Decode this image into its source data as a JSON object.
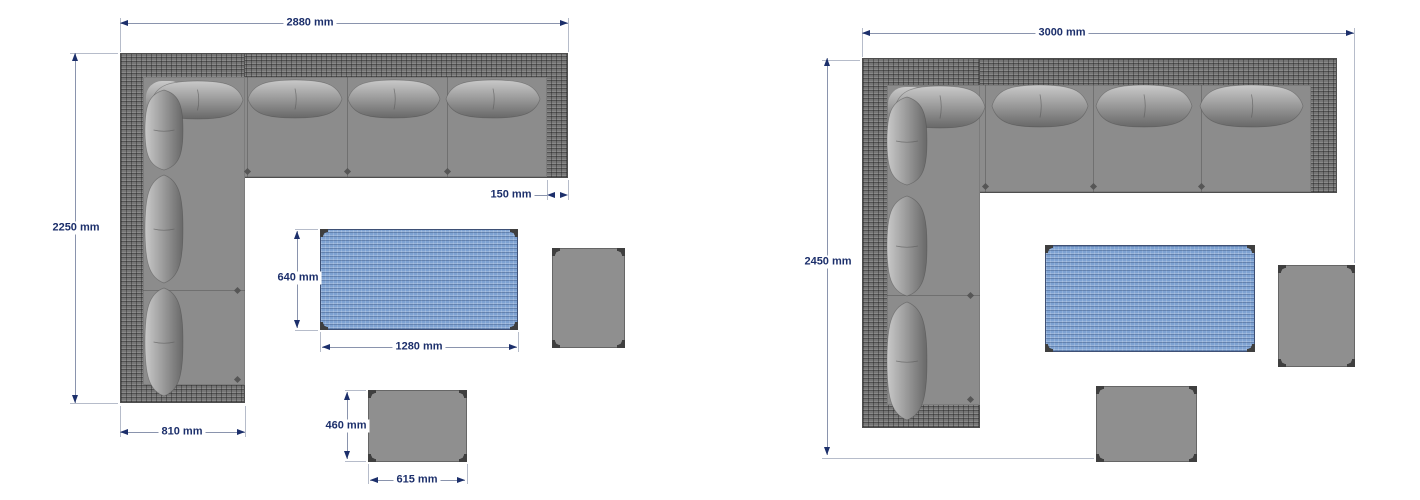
{
  "drawing_title": "corner sofa set dimension plans",
  "colors": {
    "dimension_text": "#1c2f6b",
    "dimension_line": "#8a94ad",
    "extension_line": "#b6bcca",
    "wicker_frame": "#767676",
    "sofa_seat": "#8c8c8c",
    "cushion": "#9e9e9e",
    "table_top": "#7ea2d2",
    "stool_top": "#8f8f8f",
    "background": "#ffffff"
  },
  "left_set": {
    "name": "corner sofa set (left plan)",
    "dimensions": {
      "overall_width": "2880 mm",
      "overall_depth": "2250 mm",
      "armrest_width": "150 mm",
      "arm_section_width": "810 mm",
      "table_depth": "640 mm",
      "table_width": "1280 mm",
      "ottoman_depth": "460 mm",
      "ottoman_width": "615 mm"
    }
  },
  "right_set": {
    "name": "corner sofa set (right plan)",
    "dimensions": {
      "overall_width": "3000 mm",
      "overall_depth": "2450 mm"
    }
  }
}
